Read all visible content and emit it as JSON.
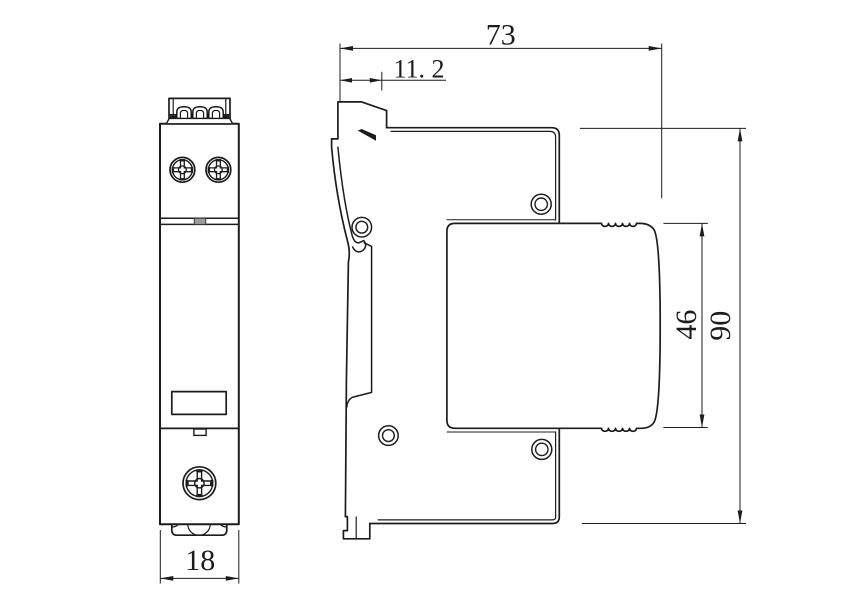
{
  "dimensions": {
    "total_depth": "73",
    "clip_offset": "11. 2",
    "module_height": "46",
    "total_height": "90",
    "body_width": "18"
  },
  "colors": {
    "line": "#1c1c1c",
    "dimension": "#1c1c1c",
    "background": "#ffffff",
    "tab": "#9c9c9c"
  }
}
